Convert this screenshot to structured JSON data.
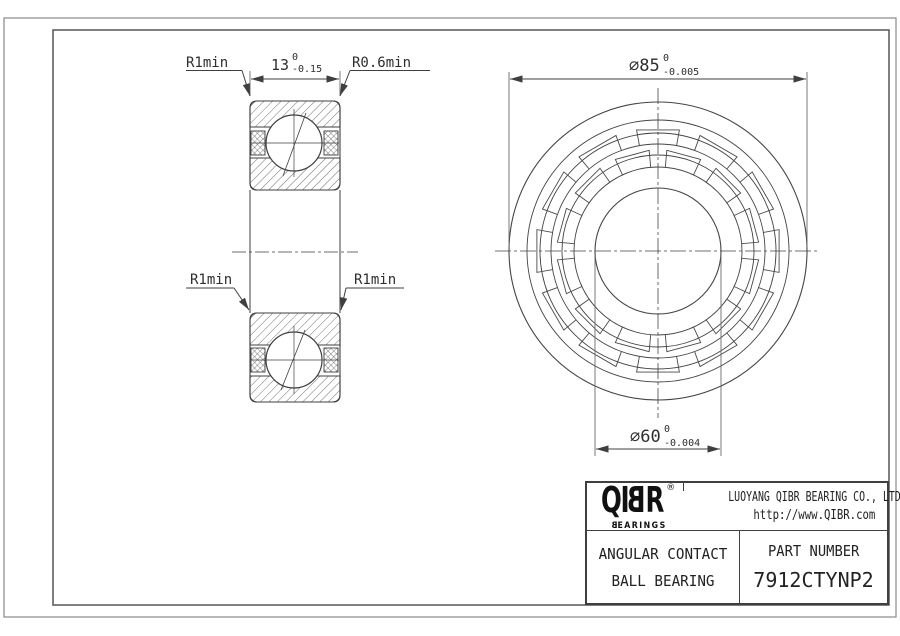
{
  "drawing": {
    "section_view": {
      "label_r1min_top": "R1min",
      "label_r06min": "R0.6min",
      "label_r1min_left": "R1min",
      "label_r1min_right": "R1min",
      "dim_width": {
        "main": "13",
        "tol_upper": "0",
        "tol_lower": "-0.15"
      }
    },
    "front_view": {
      "dim_od": {
        "main": "∅85",
        "tol_upper": "0",
        "tol_lower": "-0.005"
      },
      "dim_bore": {
        "main": "∅60",
        "tol_upper": "0",
        "tol_lower": "-0.004"
      }
    }
  },
  "title_block": {
    "logo": {
      "l1": "Q",
      "l2": "I",
      "l3": "B",
      "l4": "R",
      "registered": "®",
      "sub_b": "B",
      "sub_rest": "EARINGS"
    },
    "company": "LUOYANG QIBR BEARING CO., LTD",
    "website": "http://www.QIBR.com",
    "product_line1": "ANGULAR CONTACT",
    "product_line2": "BALL BEARING",
    "part_label": "PART NUMBER",
    "part_number": "7912CTYNP2"
  },
  "colors": {
    "line": "#3f3f3f",
    "frame_outer": "#8a8a8a",
    "frame_inner": "#555555",
    "text": "#2e2e2e",
    "background": "#ffffff"
  }
}
